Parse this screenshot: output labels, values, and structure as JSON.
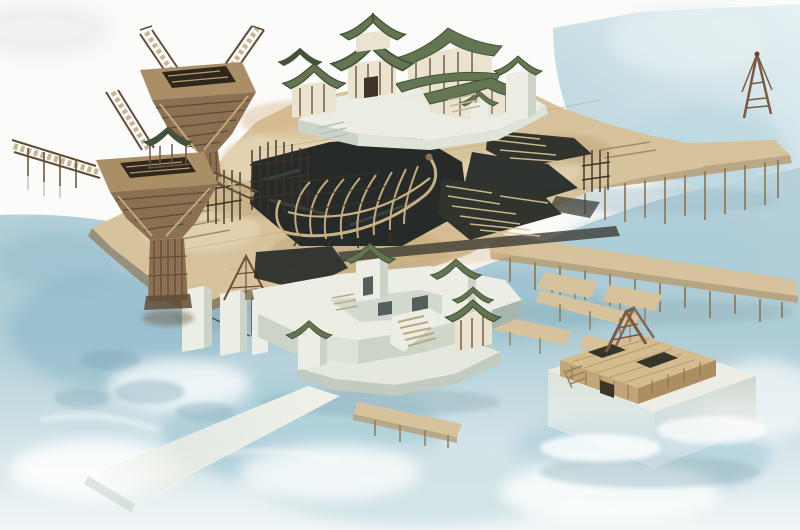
{
  "scene": {
    "alt": "Watercolor concept illustration, isometric view: a Chinese shipyard complex with wooden crane towers, a ship hull skeleton under construction in a dark dry dock, pagoda-roofed buildings with green tiled roofs, white stone terraces and gate towers, long timber piers on stilts, and a small crane island, all over pale blue water.",
    "elements": [
      "water",
      "crane-tower-upper",
      "crane-tower-lower",
      "lattice-cranes",
      "main-timber-deck",
      "dry-dock-pit",
      "ship-hull-skeleton",
      "timber-stacks",
      "scaffolding",
      "pagoda-complex",
      "stone-terraces",
      "gate-towers",
      "causeway",
      "right-piers",
      "finger-docks",
      "crane-island",
      "a-frame-crane"
    ]
  },
  "palette": {
    "paper": "#fbfbfa",
    "waterPale": "#d8e9ee",
    "waterMid": "#aacdd8",
    "waterDeep": "#8fb9c9",
    "waterShadow": "#7ba4b4",
    "foam": "#ffffff",
    "deckTan": "#d6c29b",
    "deckLight": "#e7d9b9",
    "deckDark": "#b79d74",
    "deckEdge": "#8f7856",
    "woodMid": "#8b7052",
    "woodDark": "#634c36",
    "woodDeep": "#3f3223",
    "woodTop": "#a98e66",
    "lattice": "#c0a87e",
    "pitDark": "#262b29",
    "pitTeal": "#45544f",
    "rib": "#c9b181",
    "roofGreen": "#647551",
    "roofDark": "#45523a",
    "roofLight": "#87956b",
    "stoneWhite": "#eceee5",
    "stoneGrey": "#ccd3c7",
    "stoneShadow": "#a7b5af",
    "cream": "#e9e3d0",
    "beam": "#6d5741",
    "timberDark": "#31332d"
  }
}
